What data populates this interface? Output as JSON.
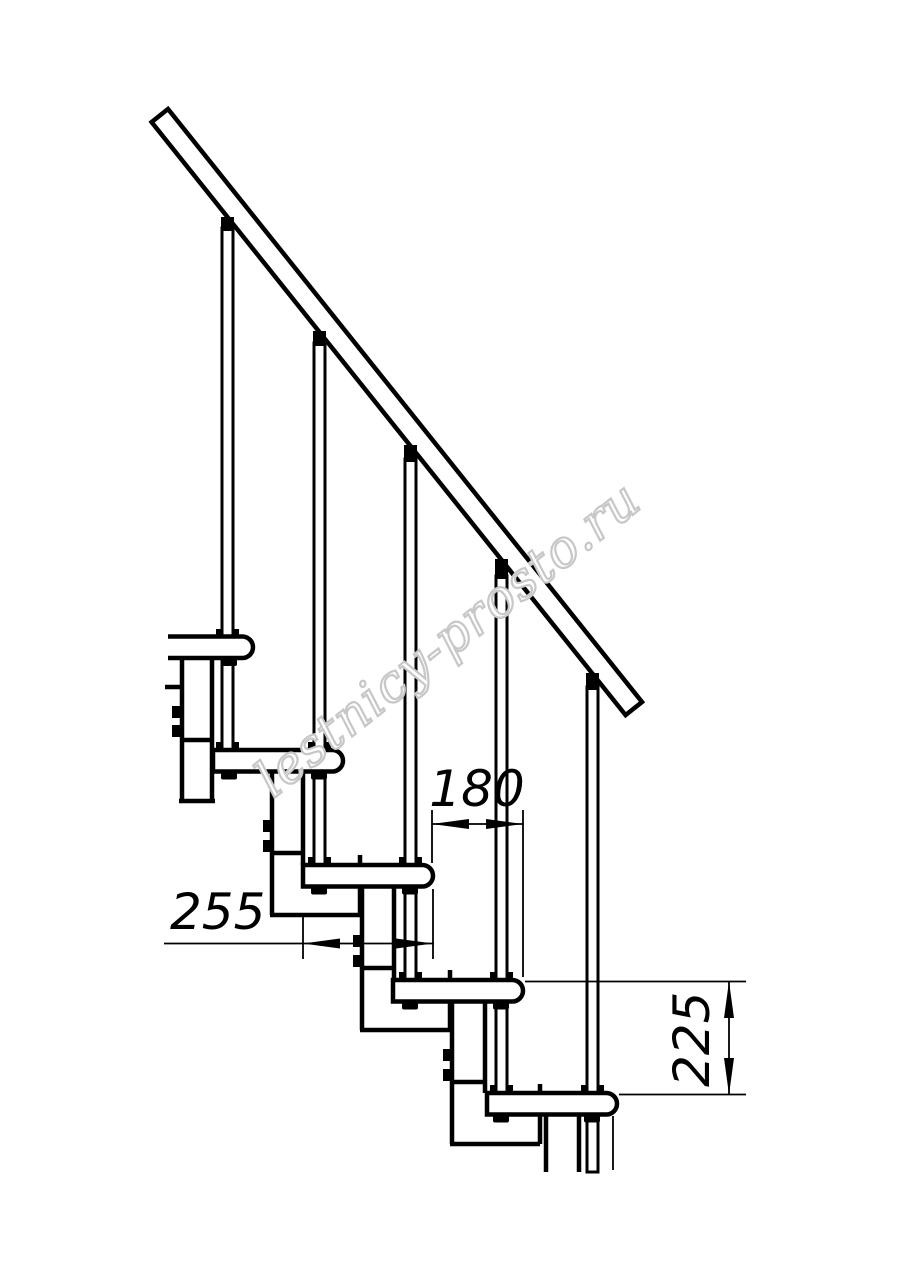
{
  "drawing": {
    "watermark": "lestnicy-prosto.ru",
    "dim_tread_depth": "255",
    "dim_step_run": "180",
    "dim_step_rise": "225",
    "line_color": "#000000",
    "watermark_color": "#c7c7c7",
    "background_color": "#ffffff"
  }
}
